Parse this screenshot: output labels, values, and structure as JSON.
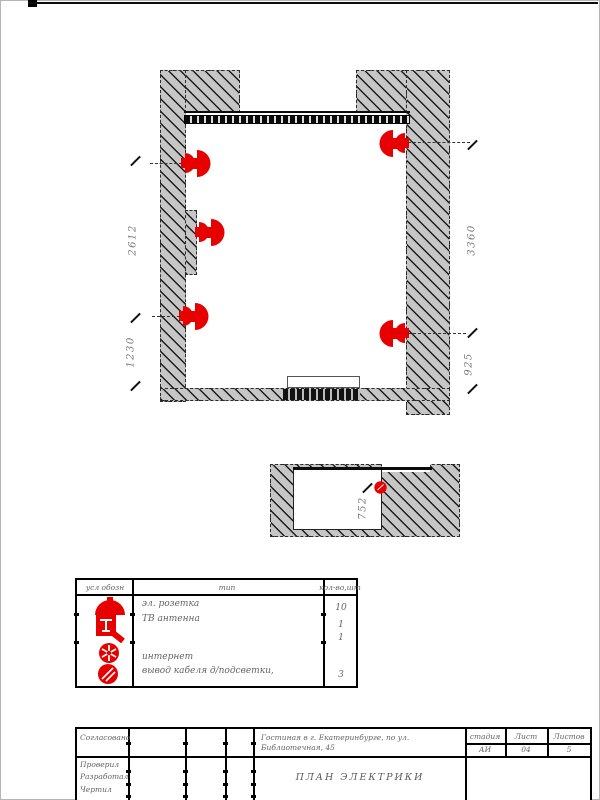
{
  "drawing": {
    "dims": {
      "left_top": "2612",
      "left_bottom": "1230",
      "right_top": "3360",
      "right_bottom": "925",
      "detail": "752"
    }
  },
  "legend": {
    "header": {
      "symbol": "усл обозн",
      "type": "тип",
      "qty": "кол-во,шт"
    },
    "rows": [
      {
        "symbol": "socket-icon",
        "type": "эл. розетка",
        "qty": "10"
      },
      {
        "symbol": "tv-antenna-icon",
        "type": "ТВ антенна",
        "qty": "1"
      },
      {
        "symbol": "internet-icon",
        "type": "интернет",
        "qty": "1"
      },
      {
        "symbol": "cable-outlet-icon",
        "type": "вывод кабеля д/подсветки,",
        "qty": "3"
      }
    ]
  },
  "title_block": {
    "approved_label": "Согласовано",
    "checked_label": "Проверил",
    "developed_label": "Разработал",
    "drawn_label": "Чертил",
    "project_line1": "Гостиная в г. Екатеринбурге, по ул.",
    "project_line2": "Библиотечная, 45",
    "drawing_title": "ПЛАН ЭЛЕКТРИКИ",
    "stage_label": "стадия",
    "stage_value": "АИ",
    "sheet_label": "Лист",
    "sheet_value": "04",
    "sheets_label": "Листов",
    "sheets_value": "5"
  },
  "colors": {
    "accent": "#e60000",
    "wall_fill": "#c6c6c6"
  }
}
